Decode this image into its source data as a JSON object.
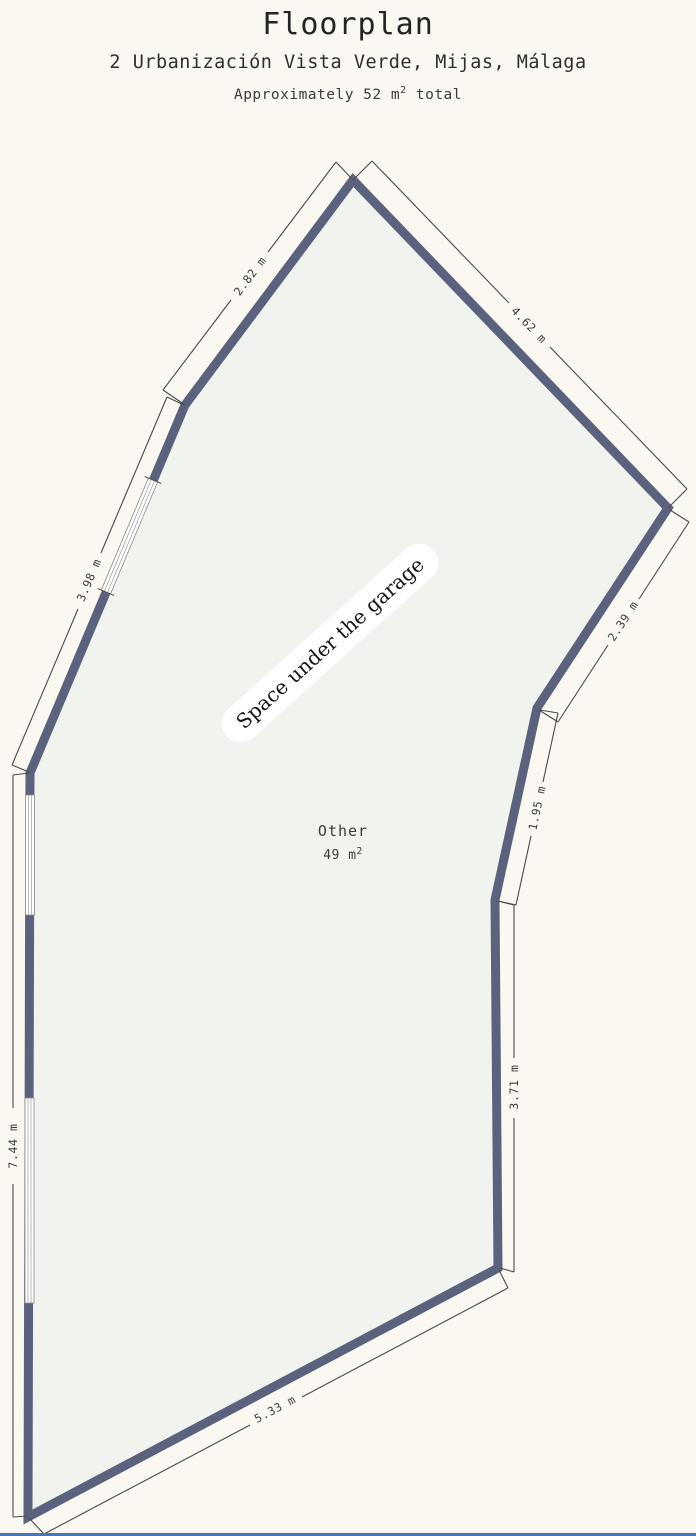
{
  "header": {
    "title": "Floorplan",
    "subtitle": "2 Urbanización Vista Verde, Mijas, Málaga",
    "area_prefix": "Approximately 52 m",
    "area_sup": "2",
    "area_suffix": " total"
  },
  "plan": {
    "overlay_label": "Space under the garage",
    "room": {
      "name": "Other",
      "area_value": "49 m",
      "area_sup": "2"
    },
    "dimensions": [
      {
        "side": "upper-left",
        "label": "2.82 m"
      },
      {
        "side": "upper-right",
        "label": "4.62 m"
      },
      {
        "side": "right-upper",
        "label": "2.39 m"
      },
      {
        "side": "right-middle",
        "label": "1.95 m"
      },
      {
        "side": "right-lower",
        "label": "3.71 m"
      },
      {
        "side": "bottom",
        "label": "5.33 m"
      },
      {
        "side": "left",
        "label": "7.44 m"
      },
      {
        "side": "left-upper",
        "label": "3.98 m"
      }
    ],
    "colors": {
      "wall": "#5b627e",
      "interior": "#f1f3ee",
      "background": "#faf8f1",
      "dimension_text": "#3b3b3b",
      "dimension_line": "#4a4a4a"
    }
  }
}
